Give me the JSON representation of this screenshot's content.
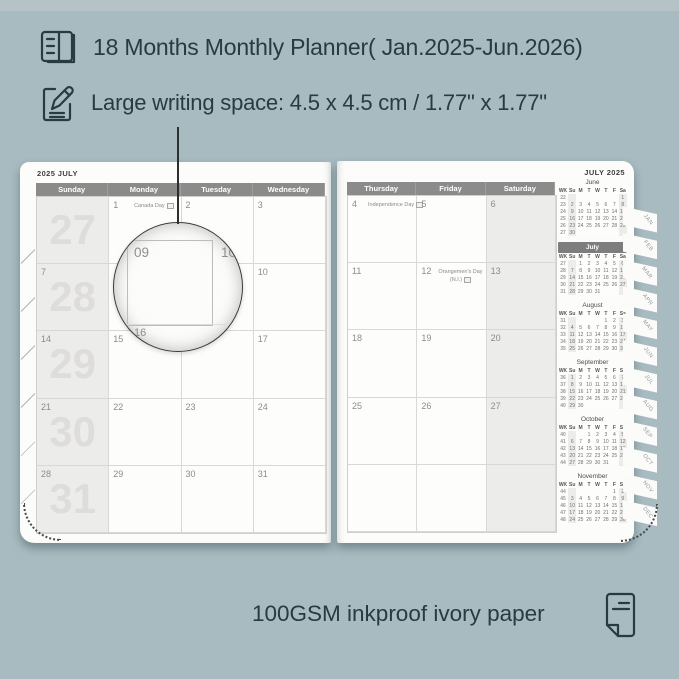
{
  "colors": {
    "background": "#a7bbc0",
    "ink": "#2a3a43",
    "day_header_bar": "#8b8b8b",
    "weekend_fill": "#ececea",
    "week_number_watermark": "#dedddc",
    "mini_july_bar": "#7d7d7d",
    "page": "#fcfcfa"
  },
  "features": [
    {
      "icon": "planner-book-icon",
      "text": "18 Months Monthly Planner( Jan.2025-Jun.2026)"
    },
    {
      "icon": "writing-pencil-icon",
      "text": "Large writing space: 4.5 x 4.5 cm / 1.77\" x 1.77\""
    }
  ],
  "footer": {
    "icon": "paper-sheet-icon",
    "text": "100GSM inkproof ivory paper"
  },
  "planner": {
    "left_page": {
      "title": "2025 JULY",
      "day_headers": [
        "Sunday",
        "Monday",
        "Tuesday",
        "Wednesday"
      ],
      "week_numbers": [
        "27",
        "28",
        "29",
        "30",
        "31"
      ],
      "sunday_dates": [
        "",
        "7",
        "14",
        "21",
        "28"
      ],
      "rows": [
        [
          {
            "day": "1",
            "note": "Canada Day",
            "flag": true
          },
          {
            "day": "2"
          },
          {
            "day": "3"
          }
        ],
        [
          {
            "day": ""
          },
          {
            "day": ""
          },
          {
            "day": "10"
          }
        ],
        [
          {
            "day": "15"
          },
          {
            "day": ""
          },
          {
            "day": "17"
          }
        ],
        [
          {
            "day": "22"
          },
          {
            "day": "23"
          },
          {
            "day": "24"
          }
        ],
        [
          {
            "day": "29"
          },
          {
            "day": "30"
          },
          {
            "day": "31"
          }
        ]
      ]
    },
    "right_page": {
      "title": "JULY 2025",
      "day_headers": [
        "Thursday",
        "Friday",
        "Saturday"
      ],
      "rows": [
        [
          {
            "day": "4",
            "note": "Independence Day",
            "flag": true
          },
          {
            "day": "5"
          },
          {
            "day": "6"
          }
        ],
        [
          {
            "day": "11"
          },
          {
            "day": "12",
            "note": "Orangemen's Day",
            "note2": "(N.I.)",
            "flag": true
          },
          {
            "day": "13"
          }
        ],
        [
          {
            "day": "18"
          },
          {
            "day": "19"
          },
          {
            "day": "20"
          }
        ],
        [
          {
            "day": "25"
          },
          {
            "day": "26"
          },
          {
            "day": "27"
          }
        ],
        [
          {
            "day": ""
          },
          {
            "day": ""
          },
          {
            "day": ""
          }
        ]
      ]
    },
    "magnifier": {
      "magnified_day": "09",
      "adjacent_right": "10",
      "adjacent_below": "16"
    },
    "mini_calendar_header": [
      "WK",
      "Su",
      "M",
      "T",
      "W",
      "T",
      "F",
      "Sa"
    ],
    "mini_months": [
      {
        "name": "June",
        "highlight": false,
        "rows": [
          [
            "22",
            [
              "",
              "",
              "",
              "",
              "",
              "",
              "1"
            ]
          ],
          [
            "23",
            [
              "2",
              "3",
              "4",
              "5",
              "6",
              "7",
              "8"
            ]
          ],
          [
            "24",
            [
              "9",
              "10",
              "11",
              "12",
              "13",
              "14",
              "15"
            ]
          ],
          [
            "25",
            [
              "16",
              "17",
              "18",
              "19",
              "20",
              "21",
              "22"
            ]
          ],
          [
            "26",
            [
              "23",
              "24",
              "25",
              "26",
              "27",
              "28",
              "29"
            ]
          ],
          [
            "27",
            [
              "30",
              "",
              "",
              "",
              "",
              "",
              ""
            ]
          ]
        ]
      },
      {
        "name": "July",
        "highlight": true,
        "rows": [
          [
            "27",
            [
              "",
              "1",
              "2",
              "3",
              "4",
              "5",
              "6"
            ]
          ],
          [
            "28",
            [
              "7",
              "8",
              "9",
              "10",
              "11",
              "12",
              "13"
            ]
          ],
          [
            "29",
            [
              "14",
              "15",
              "16",
              "17",
              "18",
              "19",
              "20"
            ]
          ],
          [
            "30",
            [
              "21",
              "22",
              "23",
              "24",
              "25",
              "26",
              "27"
            ]
          ],
          [
            "31",
            [
              "28",
              "29",
              "30",
              "31",
              "",
              "",
              ""
            ]
          ]
        ]
      },
      {
        "name": "August",
        "highlight": false,
        "rows": [
          [
            "31",
            [
              "",
              "",
              "",
              "",
              "1",
              "2",
              "3"
            ]
          ],
          [
            "32",
            [
              "4",
              "5",
              "6",
              "7",
              "8",
              "9",
              "10"
            ]
          ],
          [
            "33",
            [
              "11",
              "12",
              "13",
              "14",
              "15",
              "16",
              "17"
            ]
          ],
          [
            "34",
            [
              "18",
              "19",
              "20",
              "21",
              "22",
              "23",
              "24"
            ]
          ],
          [
            "35",
            [
              "25",
              "26",
              "27",
              "28",
              "29",
              "30",
              "31"
            ]
          ]
        ]
      },
      {
        "name": "September",
        "highlight": false,
        "rows": [
          [
            "36",
            [
              "1",
              "2",
              "3",
              "4",
              "5",
              "6",
              "7"
            ]
          ],
          [
            "37",
            [
              "8",
              "9",
              "10",
              "11",
              "12",
              "13",
              "14"
            ]
          ],
          [
            "38",
            [
              "15",
              "16",
              "17",
              "18",
              "19",
              "20",
              "21"
            ]
          ],
          [
            "39",
            [
              "22",
              "23",
              "24",
              "25",
              "26",
              "27",
              "28"
            ]
          ],
          [
            "40",
            [
              "29",
              "30",
              "",
              "",
              "",
              "",
              ""
            ]
          ]
        ]
      },
      {
        "name": "October",
        "highlight": false,
        "rows": [
          [
            "40",
            [
              "",
              "",
              "1",
              "2",
              "3",
              "4",
              "5"
            ]
          ],
          [
            "41",
            [
              "6",
              "7",
              "8",
              "9",
              "10",
              "11",
              "12"
            ]
          ],
          [
            "42",
            [
              "13",
              "14",
              "15",
              "16",
              "17",
              "18",
              "19"
            ]
          ],
          [
            "43",
            [
              "20",
              "21",
              "22",
              "23",
              "24",
              "25",
              "26"
            ]
          ],
          [
            "44",
            [
              "27",
              "28",
              "29",
              "30",
              "31",
              "",
              ""
            ]
          ]
        ]
      },
      {
        "name": "November",
        "highlight": false,
        "rows": [
          [
            "44",
            [
              "",
              "",
              "",
              "",
              "",
              "1",
              "2"
            ]
          ],
          [
            "45",
            [
              "3",
              "4",
              "5",
              "6",
              "7",
              "8",
              "9"
            ]
          ],
          [
            "46",
            [
              "10",
              "11",
              "12",
              "13",
              "14",
              "15",
              "16"
            ]
          ],
          [
            "47",
            [
              "17",
              "18",
              "19",
              "20",
              "21",
              "22",
              "23"
            ]
          ],
          [
            "48",
            [
              "24",
              "25",
              "26",
              "27",
              "28",
              "29",
              "30"
            ]
          ]
        ]
      }
    ],
    "tabs": [
      "JAN",
      "FEB",
      "MAR",
      "APR",
      "MAY",
      "JUN",
      "JUL",
      "AUG",
      "SEP",
      "OCT",
      "NOV",
      "DEC"
    ]
  }
}
